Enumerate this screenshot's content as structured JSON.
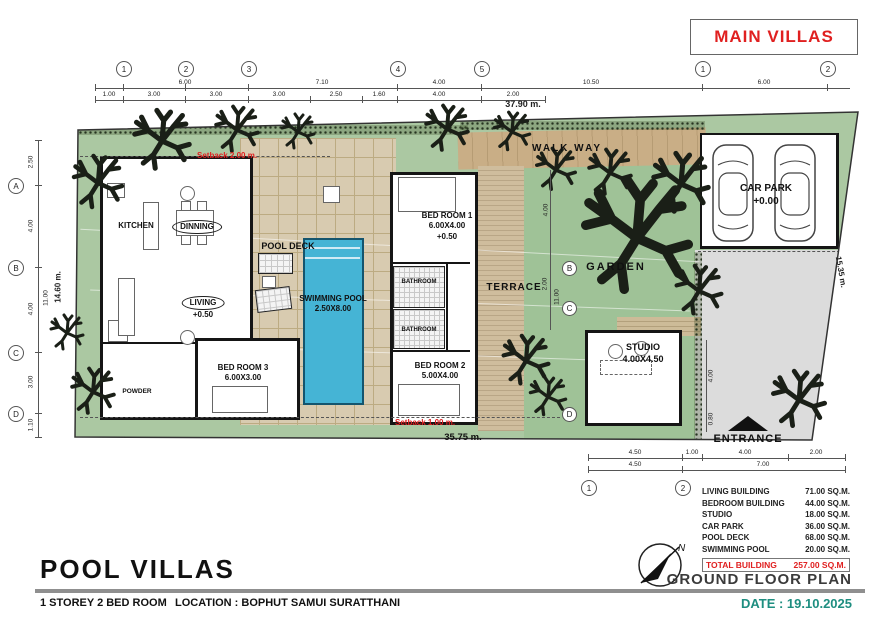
{
  "title_box": {
    "label": "MAIN VILLAS"
  },
  "grid": {
    "top": [
      "1",
      "2",
      "3",
      "4",
      "5",
      "1",
      "2"
    ],
    "left": [
      "A",
      "B",
      "C",
      "D"
    ],
    "mid": [
      "B",
      "C",
      "D"
    ],
    "bottom": [
      "1",
      "2"
    ]
  },
  "dims": {
    "top_row1": [
      "6.00",
      "7.10",
      "4.00",
      "10.50",
      "6.00"
    ],
    "top_row2": [
      "1.00",
      "3.00",
      "3.00",
      "3.00",
      "2.50",
      "1.60",
      "4.00",
      "2.00"
    ],
    "top_total": "37.90 m.",
    "left": [
      "2.50",
      "4.00",
      "4.00",
      "3.00",
      "1.10"
    ],
    "left_inner": "11.00",
    "left_total": "14.60 m.",
    "right_total": "15.35 m.",
    "bottom_total": "35.75 m.",
    "entry_row1": [
      "4.50",
      "1.00",
      "4.00",
      "2.00"
    ],
    "entry_row2": [
      "4.50",
      "7.00"
    ],
    "side": [
      "4.00",
      "2.00",
      "11.00",
      "4.00",
      "0.80"
    ]
  },
  "annotations": {
    "setback_top": "Setback 2.00 m.",
    "setback_bottom": "Setback 1.00 m."
  },
  "rooms": {
    "kitchen": "KITCHEN",
    "dinning": "DINNING",
    "living": "LIVING",
    "living_level": "+0.50",
    "pool_deck": "POOL DECK",
    "swimming_pool": "SWIMMING POOL",
    "swimming_pool_size": "2.50X8.00",
    "bed_room_1": "BED ROOM 1",
    "bed_room_1_size": "6.00X4.00",
    "bed_room_1_level": "+0.50",
    "bathroom_a": "BATHROOM",
    "bathroom_b": "BATHROOM",
    "terrace": "TERRACE",
    "bed_room_2": "BED ROOM 2",
    "bed_room_2_size": "5.00X4.00",
    "bed_room_3": "BED ROOM 3",
    "bed_room_3_size": "6.00X3.00",
    "powder": "POWDER",
    "garden": "GARDEN",
    "studio": "STUDIO",
    "studio_size": "4.00X4.50",
    "car_park": "CAR PARK",
    "car_park_level": "+0.00",
    "walk_way": "WALK WAY",
    "entrance": "ENTRANCE"
  },
  "area_table": {
    "rows": [
      {
        "label": "LIVING BUILDING",
        "value": "71.00 SQ.M."
      },
      {
        "label": "BEDROOM BUILDING",
        "value": "44.00 SQ.M."
      },
      {
        "label": "STUDIO",
        "value": "18.00 SQ.M."
      },
      {
        "label": "CAR PARK",
        "value": "36.00 SQ.M."
      },
      {
        "label": "POOL DECK",
        "value": "68.00 SQ.M."
      },
      {
        "label": "SWIMMING POOL",
        "value": "20.00 SQ.M."
      }
    ],
    "total_label": "TOTAL BUILDING",
    "total_value": "257.00 SQ.M."
  },
  "footer": {
    "title": "POOL VILLAS",
    "spec": "1 STOREY 2 BED ROOM",
    "location": "LOCATION : BOPHUT  SAMUI  SURATTHANI",
    "plan_name": "GROUND FLOOR PLAN",
    "date": "DATE : 19.10.2025"
  },
  "compass": {
    "north": "N"
  },
  "colors": {
    "accent_red": "#e02020",
    "date_teal": "#1e8e80",
    "grass": "#abc8a2",
    "deck_tan": "#d8cbb0",
    "walkway_tan": "#c9ae86",
    "pool_blue": "#45b4d5",
    "driveway_gray": "#dcdcdc"
  }
}
